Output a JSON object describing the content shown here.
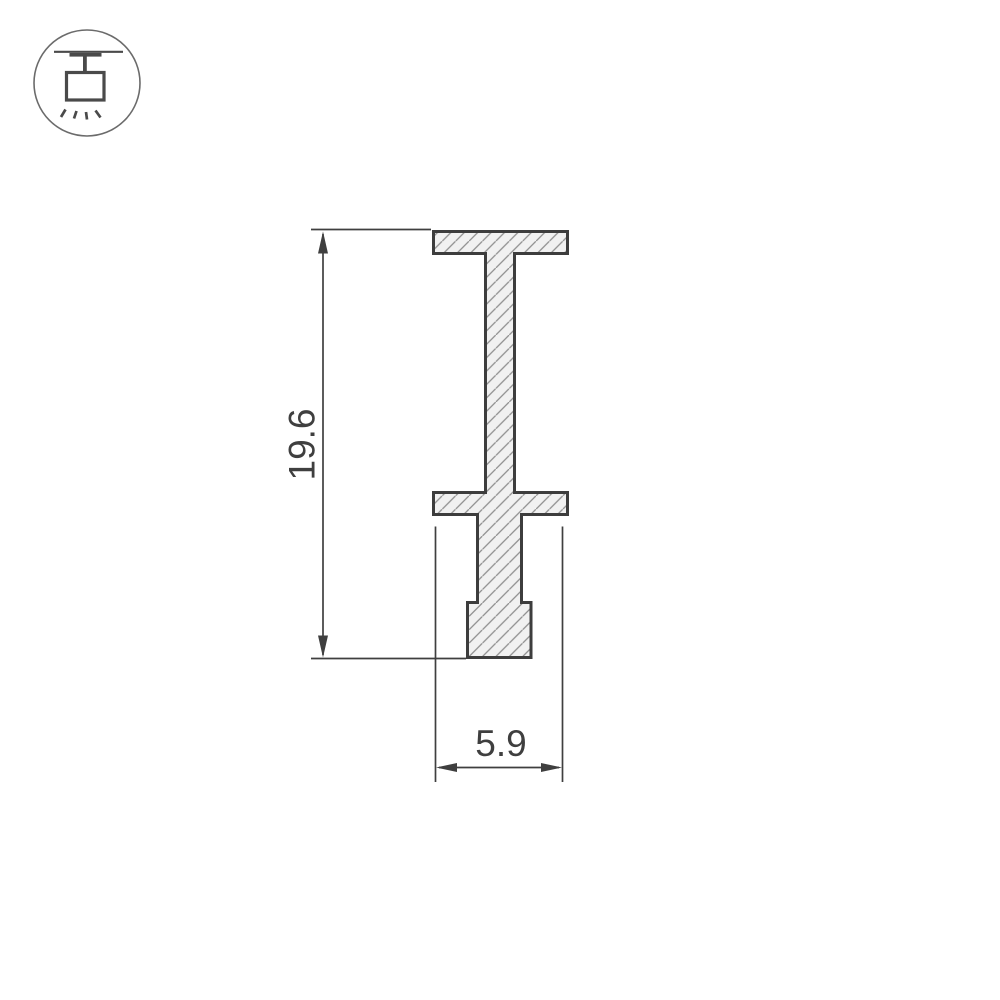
{
  "page": {
    "background": "#ffffff",
    "content_type": "technical drawing of extruded profile cross-section"
  },
  "icon": {
    "name": "ceiling-pendant-light-icon",
    "meaning": "track-mounted ceiling light fixture symbol",
    "stroke_color": "#4a4a4a",
    "circle_color": "#6b6b6b"
  },
  "profile": {
    "description": "I-beam shaped hanger profile cross-section with diagonal section hatching",
    "fill_color": "#f1f1f1",
    "outline_color": "#3d3d3d",
    "hatch_color": "#8d8d8d"
  },
  "dimensions": {
    "height": {
      "value": "19.6",
      "orientation": "vertical"
    },
    "width": {
      "value": "5.9",
      "orientation": "horizontal"
    },
    "line_color": "#3f3f3f"
  }
}
